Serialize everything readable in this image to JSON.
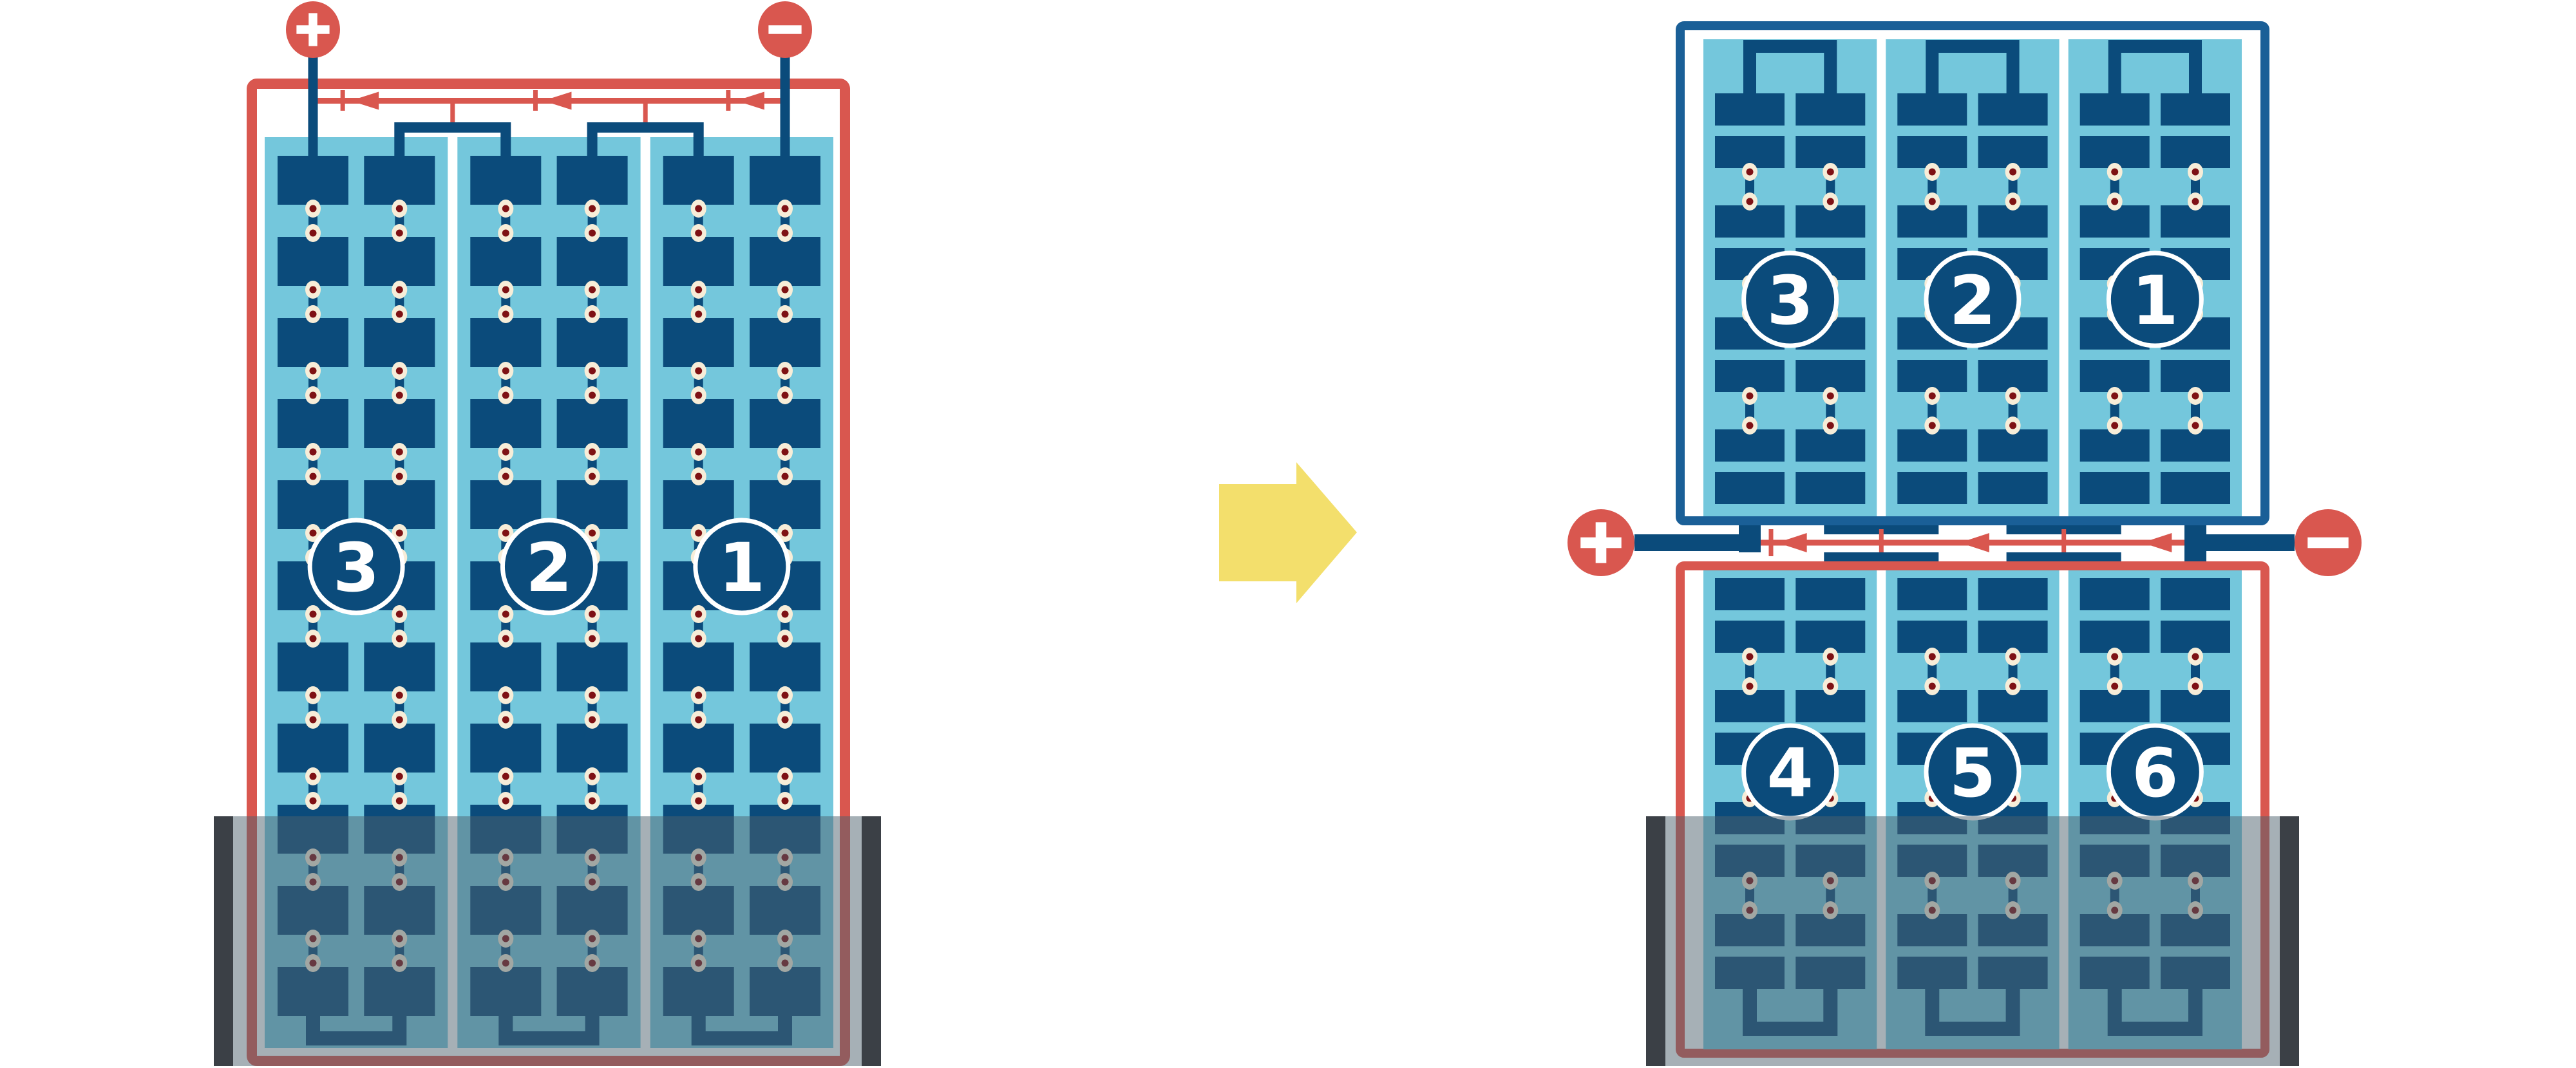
{
  "diagram": {
    "description": "battery cell construction diagram, 3-cell battery rearranged into 6-cell battery",
    "left_battery": {
      "terminals": {
        "positive_symbol": "+",
        "negative_symbol": "-"
      },
      "cells": [
        {
          "label": "3"
        },
        {
          "label": "2"
        },
        {
          "label": "1"
        }
      ],
      "flow_arrow_count": 3,
      "flow_direction": "left"
    },
    "transition": {
      "arrow_direction": "right"
    },
    "right_battery": {
      "terminals": {
        "positive_symbol": "+",
        "negative_symbol": "-"
      },
      "top_row_cells": [
        {
          "label": "3"
        },
        {
          "label": "2"
        },
        {
          "label": "1"
        }
      ],
      "bottom_row_cells": [
        {
          "label": "4"
        },
        {
          "label": "5"
        },
        {
          "label": "6"
        }
      ],
      "flow_arrow_count": 3,
      "flow_direction": "left"
    },
    "colors": {
      "coral_red": "#D9574F",
      "plate_navy": "#0B4B7B",
      "frame_blue": "#1A5F97",
      "light_blue": "#74C7DC",
      "rivet_cream": "#F7EDD8",
      "rivet_dot": "#7E1114",
      "arrow_yellow": "#F3DF6C",
      "case_bar_dark": "#3B4046",
      "case_overlay": "rgba(77,97,110,0.5)",
      "white": "#ffffff"
    }
  }
}
